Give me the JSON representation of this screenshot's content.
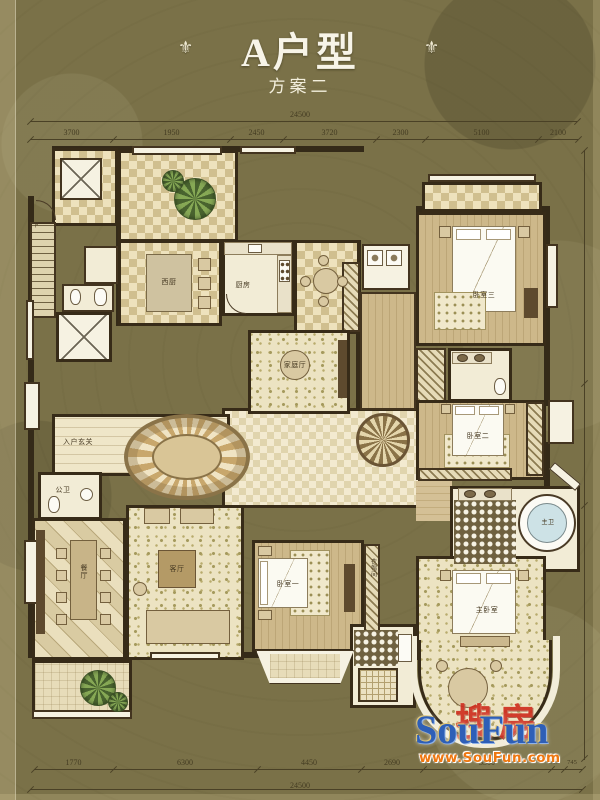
{
  "title": {
    "main": "A户型",
    "sub": "方案二"
  },
  "icons": {
    "ornament_glyph": "⚜",
    "plant": "starburst-shrub",
    "elevator": "crossed-box"
  },
  "dimensions": {
    "top": {
      "total": "24500",
      "segments": [
        "3700",
        "1950",
        "2450",
        "3720",
        "2300",
        "5100",
        "2100"
      ]
    },
    "bottom": {
      "total": "24500",
      "segments": [
        "1770",
        "6300",
        "4450",
        "2690",
        "5500",
        "955",
        "745"
      ]
    }
  },
  "plan": {
    "labels": [
      {
        "name": "entry-foyer",
        "text": "入户玄关"
      },
      {
        "name": "guest-bath",
        "text": "公卫"
      },
      {
        "name": "dining-room",
        "text": "餐厅"
      },
      {
        "name": "living-room",
        "text": "客厅"
      },
      {
        "name": "west-kitchen",
        "text": "西厨"
      },
      {
        "name": "kitchen",
        "text": "厨房"
      },
      {
        "name": "family-room",
        "text": "家庭厅"
      },
      {
        "name": "bedroom-3",
        "text": "卧室三"
      },
      {
        "name": "bedroom-2",
        "text": "卧室二"
      },
      {
        "name": "bedroom-1",
        "text": "卧室一"
      },
      {
        "name": "master-bedroom",
        "text": "主卧室"
      },
      {
        "name": "master-bath",
        "text": "主卫"
      },
      {
        "name": "walk-in-closet",
        "text": "衣帽间"
      },
      {
        "name": "stair-down",
        "text": "下"
      }
    ]
  },
  "watermark": {
    "cn": "搜房",
    "en": "SouFun",
    "url": "www.SouFun.com"
  },
  "colors": {
    "background": "#7a7148",
    "wall": "#342a18",
    "floor_light": "#f2ecd6",
    "tile_tan": "#d0bf8f",
    "watermark_blue": "#2e5fb7",
    "watermark_red": "#cf2f20",
    "watermark_orange": "#ee7710",
    "title_white": "#f7f4e8"
  }
}
